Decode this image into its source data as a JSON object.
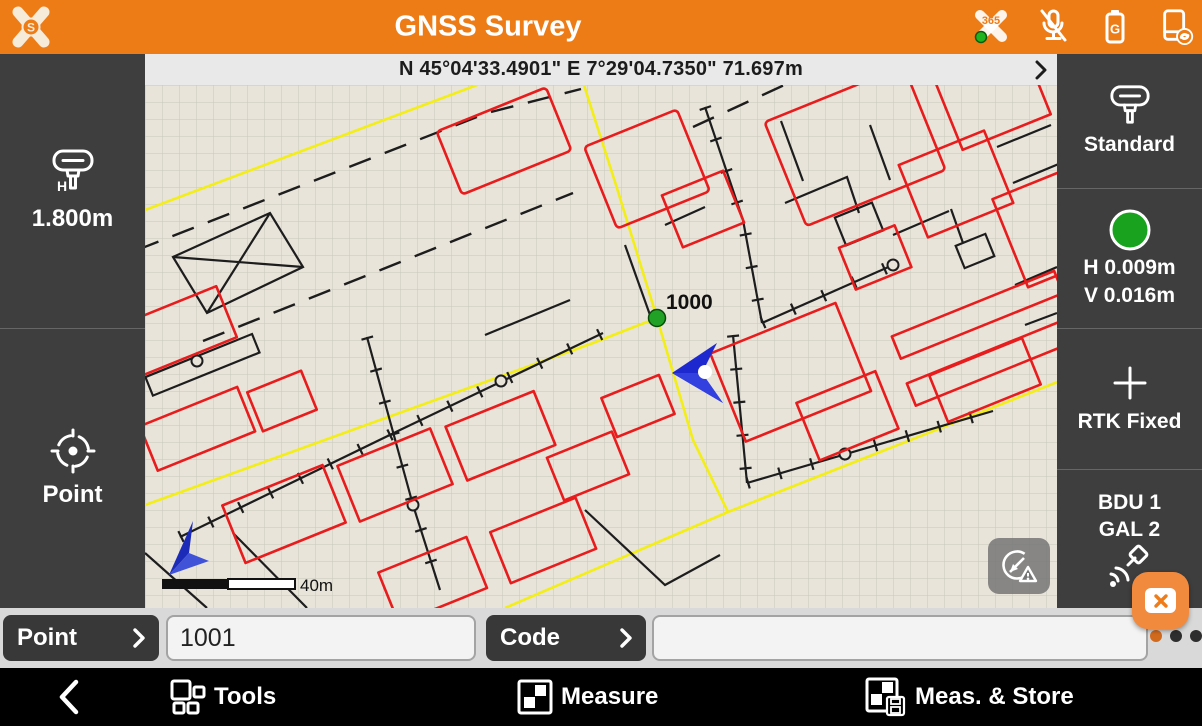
{
  "header": {
    "title": "GNSS Survey",
    "logo_letter": "S",
    "xpad365_badge": "365",
    "battery_letter": "G"
  },
  "status_bar": {
    "coordinates": "N 45°04'33.4901\" E 7°29'04.7350\" 71.697m"
  },
  "left_sidebar": {
    "h_symbol": "H",
    "antenna_height": "1.800m",
    "point_label": "Point"
  },
  "right_sidebar": {
    "mode": "Standard",
    "h_accuracy": "H 0.009m",
    "v_accuracy": "V 0.016m",
    "fix_status": "RTK Fixed",
    "constellation_line1": "BDU 1",
    "constellation_line2": "GAL 2",
    "status_color": "#18a21d"
  },
  "map": {
    "point_label": "1000",
    "scale_label": "40m"
  },
  "inputs": {
    "point_button": "Point",
    "point_value": "1001",
    "code_button": "Code",
    "code_value": ""
  },
  "bottom_bar": {
    "tools": "Tools",
    "measure": "Measure",
    "meas_store": "Meas. & Store"
  },
  "colors": {
    "accent_orange": "#ee7c16",
    "fix_green": "#18a21d",
    "map_red": "#e81c1c",
    "map_yellow": "#f3ee15",
    "position_blue": "#1e28cf"
  }
}
